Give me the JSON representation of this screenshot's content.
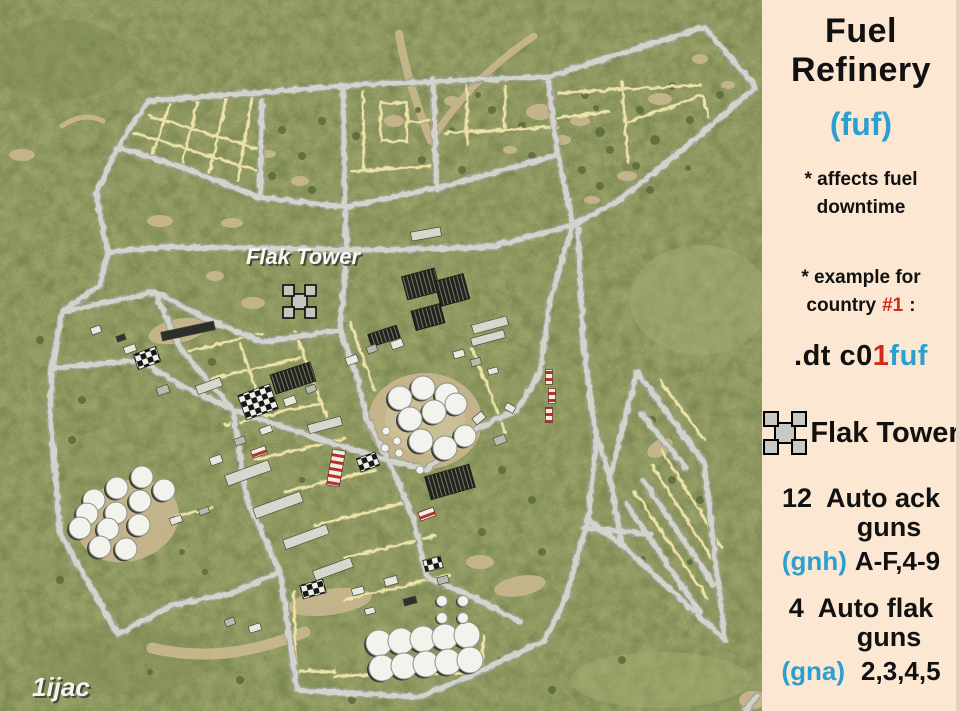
{
  "panel": {
    "title": [
      "Fuel",
      "Refinery"
    ],
    "code": "(fuf)",
    "note_effect": [
      "* affects fuel",
      "downtime"
    ],
    "note_example": [
      "* example for",
      "country",
      "#1",
      ":"
    ],
    "command": {
      "black": ".dt c0",
      "red": "1",
      "cyan": "fuf"
    },
    "legend": {
      "flak_tower": "Flak Tower"
    },
    "ack_guns": {
      "count": "12",
      "name": "Auto ack",
      "name2": "guns",
      "code": "(gnh)",
      "slots": "A-F,4-9"
    },
    "flak_guns": {
      "count": "4",
      "name": "Auto flak",
      "name2": "guns",
      "code": "(gna)",
      "slots": "2,3,4,5"
    },
    "colors": {
      "background": "#fbe7d2",
      "accent_cyan": "#2a9fd0",
      "accent_red": "#d3281e",
      "text": "#111111"
    }
  },
  "map": {
    "labels": {
      "flak_tower": "Flak Tower",
      "watermark": "1ijac"
    },
    "colors": {
      "grass": "#98a26a",
      "road": "#d0d1c9",
      "path": "#ece3a9",
      "dirt": "#c8b68e",
      "tank": "#f3f3ed"
    }
  }
}
